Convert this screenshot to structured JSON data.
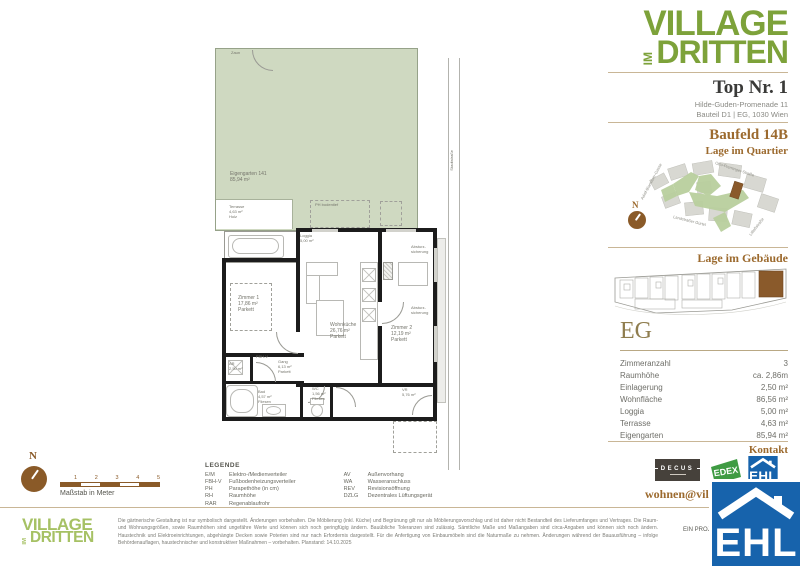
{
  "brand": {
    "line1": "VILLAGE",
    "im": "IM",
    "line2": "DRITTEN",
    "color_dark": "#7da23a",
    "color_light": "#a6c164"
  },
  "header": {
    "title": "Top Nr. 1",
    "address_line1": "Hilde-Guden-Promenade 11",
    "address_line2": "Bauteil D1 | EG, 1030 Wien"
  },
  "quartier": {
    "heading": "Baufeld 14B",
    "subheading": "Lage im Quartier",
    "streets": {
      "left": "Adolf-Blamauer-Gasse",
      "top": "Otto-Preminger-Straße",
      "middle": "Landstraßer Gürtel",
      "right": "Litfaßstraße"
    }
  },
  "compass": {
    "n": "N"
  },
  "gebaeude": {
    "heading": "Lage im Gebäude",
    "floor": "EG"
  },
  "facts": {
    "rows": [
      {
        "label": "Zimmeranzahl",
        "value": "3"
      },
      {
        "label": "Raumhöhe",
        "value": "ca. 2,86m"
      },
      {
        "label": "Einlagerung",
        "value": "2,50 m²"
      },
      {
        "label": "Wohnfläche",
        "value": "86,56 m²"
      },
      {
        "label": "Loggia",
        "value": "5,00 m²"
      },
      {
        "label": "Terrasse",
        "value": "4,63 m²"
      },
      {
        "label": "Eigengarten",
        "value": "85,94 m²"
      }
    ]
  },
  "kontakt": {
    "heading": "Kontakt",
    "email": "wohnen@villageimdritten.at",
    "logos": {
      "decus": "DECUS",
      "edex": "EDEX",
      "ehl": "EHL"
    },
    "project_note": "EIN PROJEKT VON",
    "ehl_overlay": "EHL"
  },
  "legend": {
    "title": "LEGENDE",
    "col1": [
      {
        "abbr": "E/M",
        "label": "Elektro-/Medienverteiler"
      },
      {
        "abbr": "FBH-V",
        "label": "Fußbodenheizungsverteiler"
      },
      {
        "abbr": "PH",
        "label": "Parapethöhe (in cm)"
      },
      {
        "abbr": "RH",
        "label": "Raumhöhe"
      },
      {
        "abbr": "RAR",
        "label": "Regenablaufrohr"
      }
    ],
    "col2": [
      {
        "abbr": "AV",
        "label": "Außenvorhang"
      },
      {
        "abbr": "WA",
        "label": "Wasseranschluss"
      },
      {
        "abbr": "REV",
        "label": "Revisionsöffnung"
      },
      {
        "abbr": "DZLG",
        "label": "Dezentrales Lüftungsgerät"
      }
    ]
  },
  "scalebar": {
    "ticks": [
      "1",
      "2",
      "3",
      "4",
      "5"
    ],
    "caption": "Maßstab in Meter"
  },
  "plan": {
    "zaun": "Zaun",
    "garden": {
      "name": "Eigengarten 141",
      "area": "85,94 m²"
    },
    "terrace": {
      "name": "Terrasse",
      "area": "4,63 m²",
      "floor": "Holz"
    },
    "loggia": {
      "name": "Loggia",
      "area": "5,00 m²"
    },
    "room1": {
      "name": "Zimmer 1",
      "area": "17,86 m²",
      "floor": "Parkett"
    },
    "kitchen": {
      "name": "Wohnküche",
      "area": "26,76 m²",
      "floor": "Parkett"
    },
    "room2": {
      "name": "Zimmer 2",
      "area": "12,19 m²",
      "floor": "Parkett"
    },
    "ar": {
      "name": "AR",
      "area": "2,50 m²"
    },
    "gang": {
      "name": "Gang",
      "area": "6,13 m²",
      "floor": "Parkett"
    },
    "bad": {
      "name": "Bad",
      "area": "4,57 m²",
      "floor": "Fliesen"
    },
    "wc": {
      "name": "WC",
      "area": "1,56 m²",
      "floor": "Fliesen"
    },
    "vr": {
      "name": "VR",
      "area": "5,76 m²"
    },
    "absturz_l1": "Absturz-",
    "absturz_l2": "sicherung",
    "street": "Stadtstraße",
    "ph": "PH bodentief",
    "fbhv": "FBH-V"
  },
  "footer": {
    "disclaimer": "Die gärtnerische Gestaltung ist nur symbolisch dargestellt. Änderungen vorbehalten. Die Möblierung (inkl. Küche) und Begrünung gilt nur als Möblierungsvorschlag und ist daher nicht Bestandteil des Lieferumfanges und Vertrages. Die Raum- und Wohnungsgrößen, sowie Raumhöhen sind ungefähre Werte und können sich noch geringfügig ändern. Bauübliche Toleranzen sind zulässig. Sämtliche Maße und Maßangaben sind circa-Angaben und können sich noch ändern. Haustechnik und Elektroeinrichtungen, abgehängte Decken sowie Poterien sind nur nach Erfordernis dargestellt. Für die Anfertigung von Einbaumöbeln sind die Naturmaße zu nehmen. Änderungen während der Bauausführung – infolge Behördenauflagen, haustechnischer und konstruktiver Maßnahmen – vorbehalten. Planstand: 14.10.2025"
  },
  "colors": {
    "accent_brown": "#9c6a2e",
    "plan_green": "#cfd9c1",
    "ehl_blue": "#1763ac",
    "edex_green": "#3f9b43",
    "decus_dark": "#46413b"
  }
}
